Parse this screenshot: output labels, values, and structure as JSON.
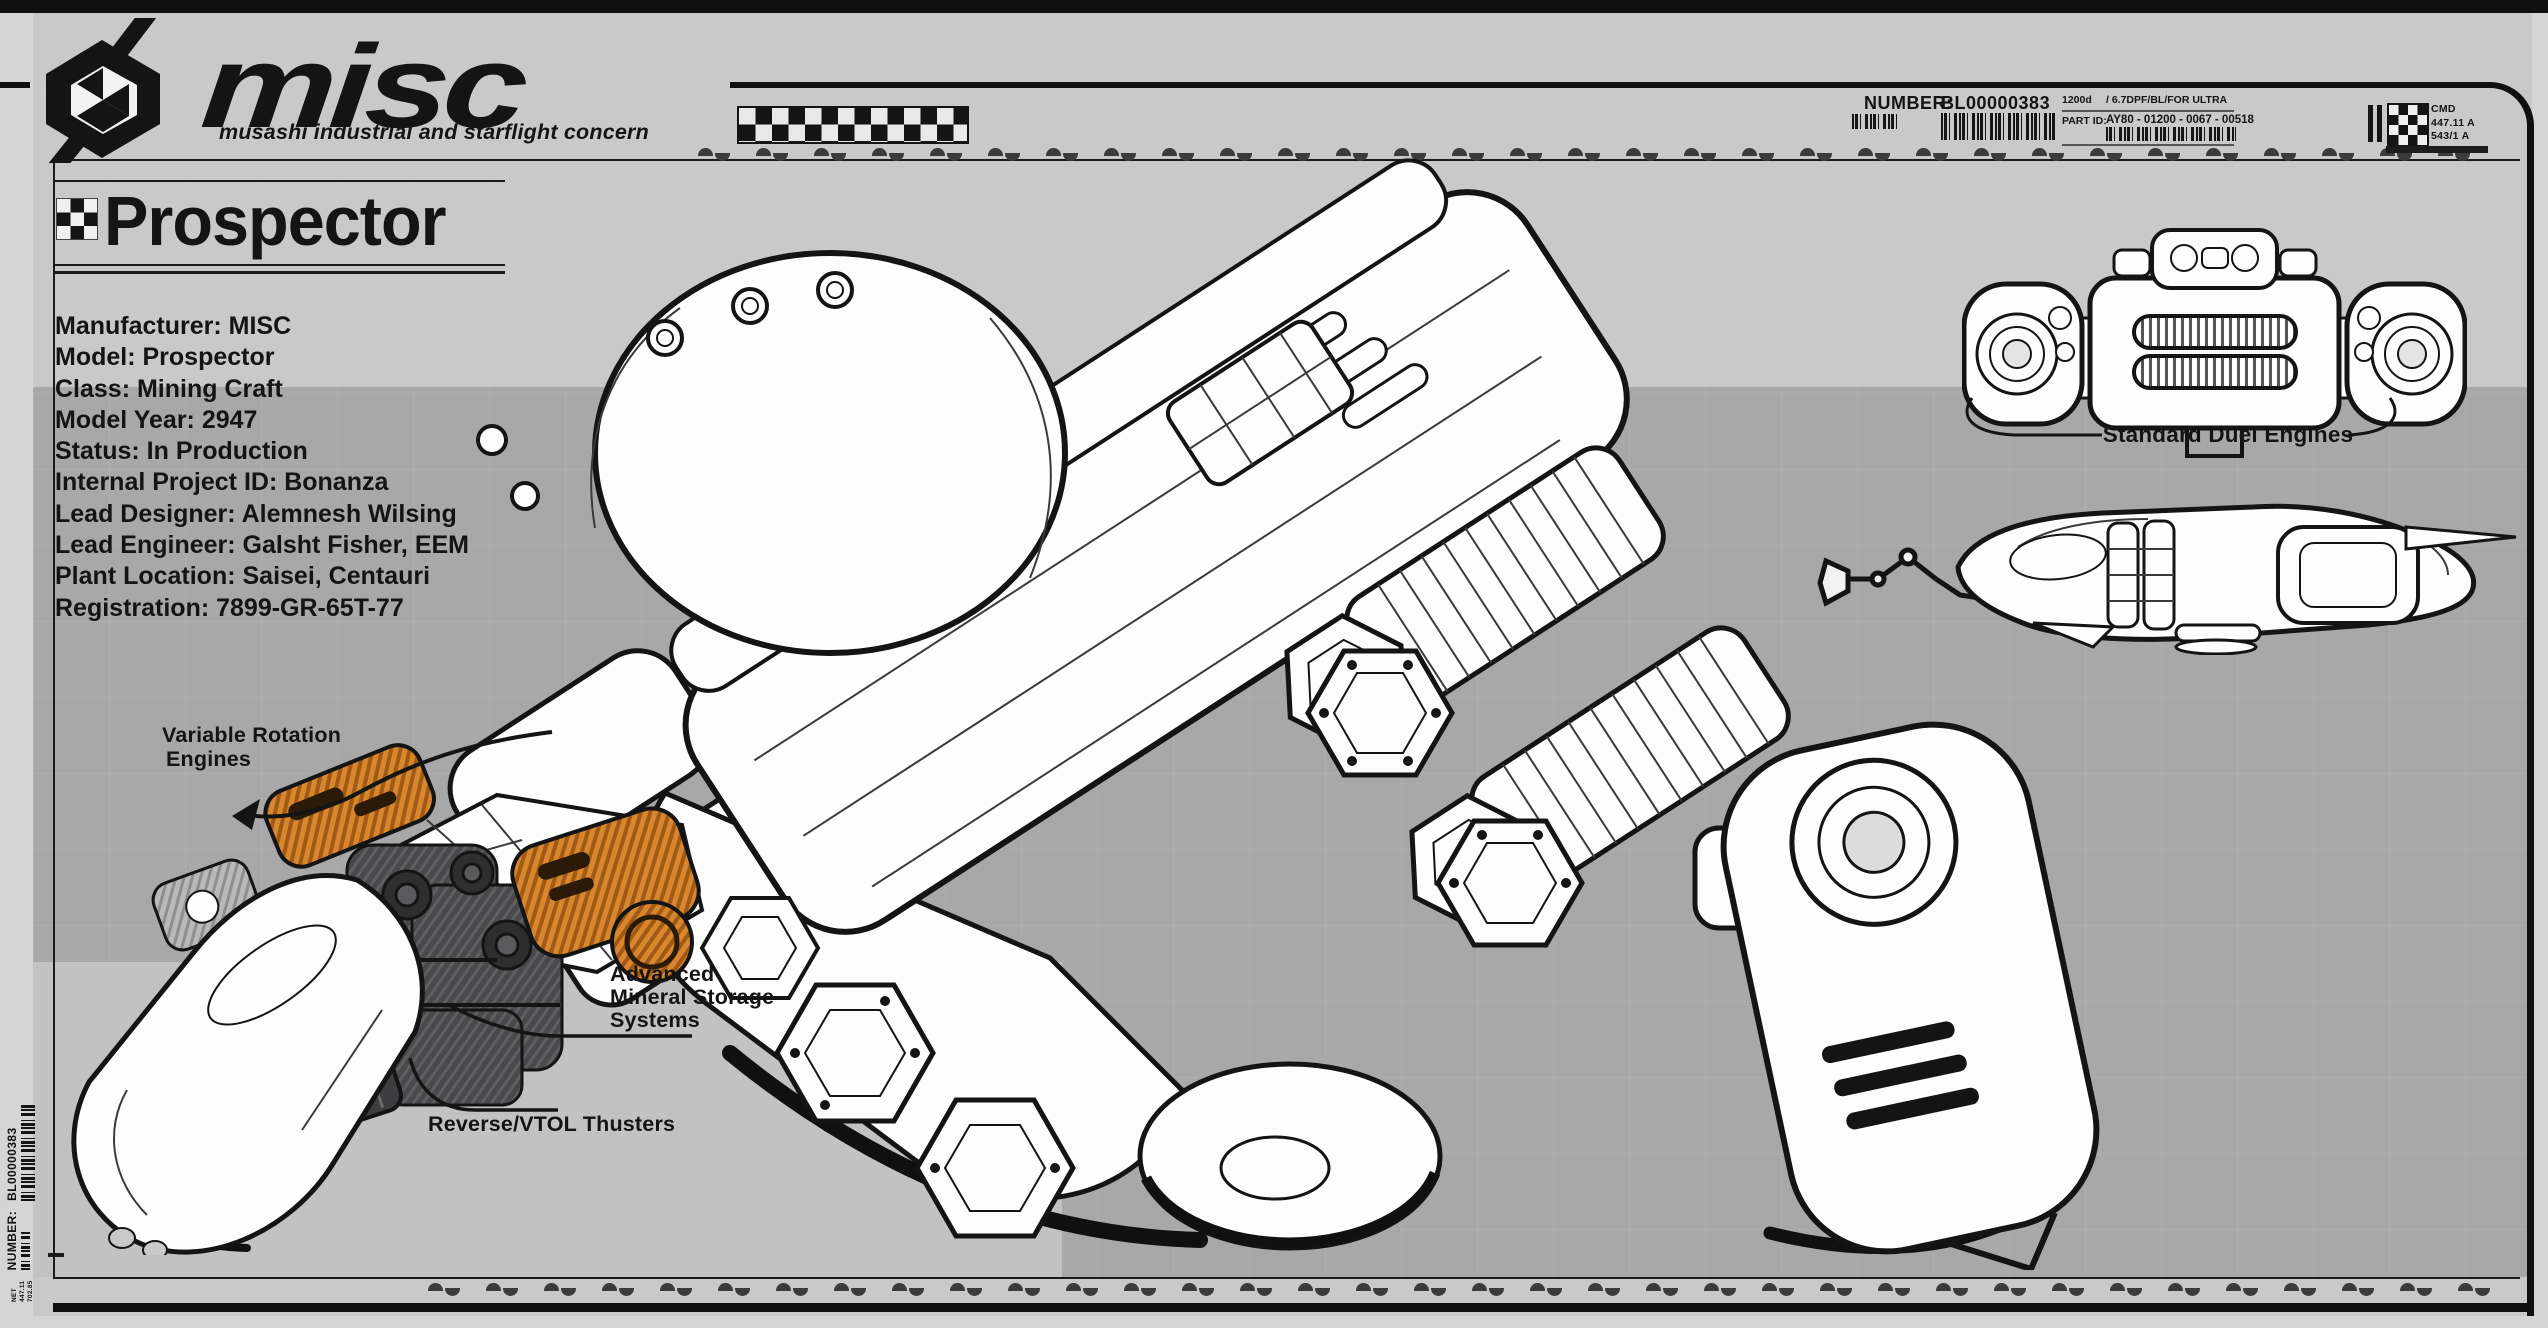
{
  "brand": {
    "wordmark": "misc",
    "tagline": "musashi industrial and starflight concern"
  },
  "header": {
    "number_label": "NUMBER:",
    "number_value": "BL00000383",
    "meta_left": "1200d",
    "meta_right": "/ 6.7DPF/BL/FOR ULTRA",
    "part_id_label": "PART ID:",
    "part_id_value": "AY80 - 01200 - 0067 - 00518",
    "register": {
      "line1": "CMD",
      "line2": "447.11 A",
      "line3": "543/1 A"
    }
  },
  "title": {
    "text": "Prospector"
  },
  "specs": [
    "Manufacturer: MISC",
    "Model: Prospector",
    "Class: Mining Craft",
    "Model Year: 2947",
    "Status: In Production",
    "Internal Project ID: Bonanza",
    "Lead Designer: Alemnesh Wilsing",
    "Lead Engineer: Galsht Fisher, EEM",
    "Plant Location: Saisei, Centauri",
    "Registration: 7899-GR-65T-77"
  ],
  "annotations": {
    "variable_rotation_line1": "Variable Rotation",
    "variable_rotation_line2": "Engines",
    "mineral_line1": "Advanced",
    "mineral_line2": "Mineral Storage",
    "mineral_line3": "Systems",
    "vtol": "Reverse/VTOL Thusters",
    "duel_engines": "Standard Duel Engines"
  },
  "side_label": {
    "number_label": "NUMBER:",
    "number_value": "BL00000383",
    "net_line1": "NET",
    "net_line2": "447.11",
    "net_line3": "702.85"
  },
  "colors": {
    "band_dark": "#a8a8a9",
    "bg_light": "#c9c9ca",
    "margin_light": "#d5d5d6",
    "ink": "#141414",
    "accent_orange": "#d8872f"
  }
}
